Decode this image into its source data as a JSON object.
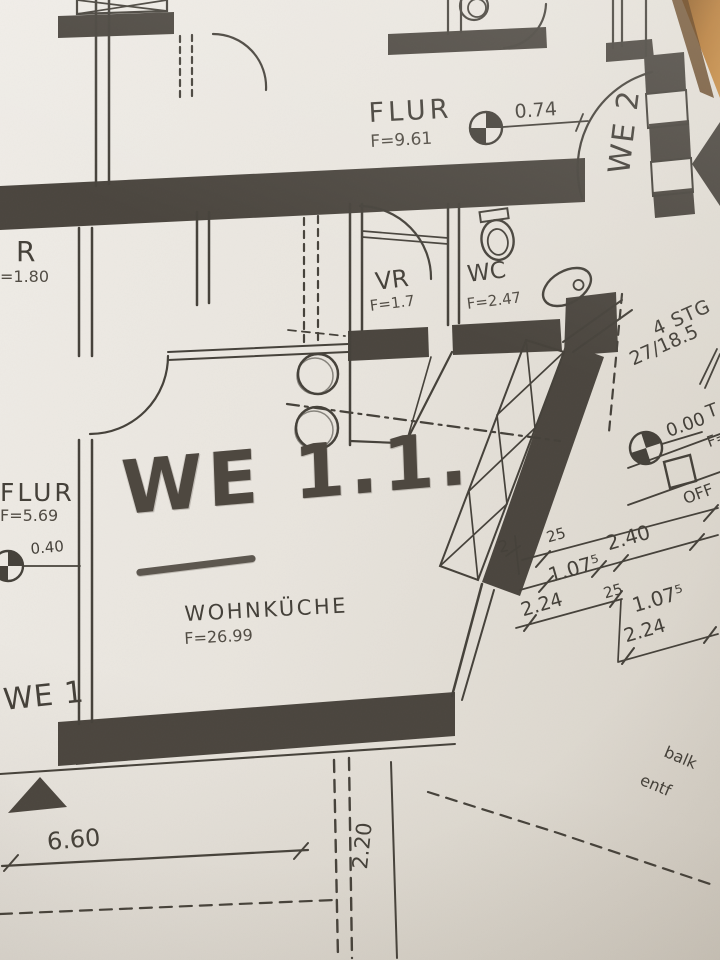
{
  "photo": {
    "paper_color": "#e9e5de",
    "ink_color": "#45413a",
    "pencil_color": "#4e4840",
    "table_color": "#b67a35"
  },
  "plan": {
    "rooms": [
      {
        "id": "flur_top",
        "name": "FLUR",
        "area": "F=9.61"
      },
      {
        "id": "vr",
        "name": "VR",
        "area": "F=1.7"
      },
      {
        "id": "wc",
        "name": "WC",
        "area": "F=2.47"
      },
      {
        "id": "wohnkueche",
        "name": "WOHNKÜCHE",
        "area": "F=26.99"
      },
      {
        "id": "flur_left",
        "name": "FLUR",
        "area": "F=5.69"
      },
      {
        "id": "room_r",
        "name": "R",
        "area": "=1.80"
      }
    ],
    "units": {
      "we2": "WE 2",
      "we1": "WE 1",
      "handwritten": "WE 1.1."
    },
    "stairs": {
      "steps": "4 STG",
      "ratio": "27/18.5"
    },
    "levels": {
      "flur": "0.74",
      "left": "0.40",
      "landing": "0.00"
    },
    "partial_labels": {
      "t": "T",
      "f": "F=",
      "offen": "OFF",
      "balk": "balk",
      "entf": "entf"
    },
    "dimensions": {
      "chain_left": "2",
      "d25a": "25",
      "d240": "2.40",
      "d107a": "1.07⁵",
      "d25b": "25",
      "d107b": "1.07⁵",
      "d224a": "2.24",
      "d224b": "2.24",
      "width_bottom": "6.60",
      "depth_right": "2.20"
    }
  }
}
